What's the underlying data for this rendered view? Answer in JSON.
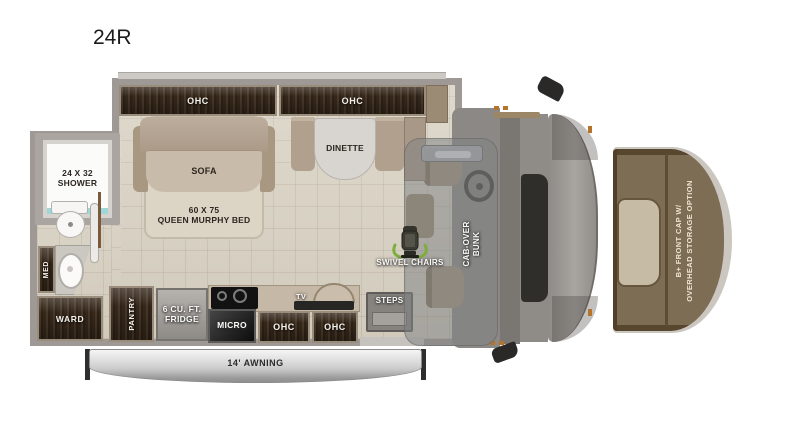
{
  "title": "24R",
  "labels": {
    "ohc": "OHC",
    "shower_l1": "24 X 32",
    "shower_l2": "SHOWER",
    "sofa": "SOFA",
    "murphy_l1": "60 X 75",
    "murphy_l2": "QUEEN MURPHY BED",
    "dinette": "DINETTE",
    "med": "MED",
    "ward": "WARD",
    "pantry": "PANTRY",
    "fridge_l1": "6 CU. FT.",
    "fridge_l2": "FRIDGE",
    "micro": "MICRO",
    "tv": "TV",
    "steps": "STEPS",
    "swivel_chairs": "SWIVEL CHAIRS",
    "bunk_l1": "CAB-OVER",
    "bunk_l2": "BUNK",
    "awning": "14' AWNING",
    "front_cap_l1": "B+ FRONT CAP W/",
    "front_cap_l2": "OVERHEAD STORAGE OPTION"
  },
  "colors": {
    "floor_tile": "#d8d1c2",
    "wall_gray": "#9e9995",
    "wood_dark": "#34271b",
    "wood_frame": "#9a8d7b",
    "upholstery_tan": "#b3a492",
    "awning_silver": "#c9c9c9",
    "front_cap_brown": "#7e6d55",
    "swivel_arrow_green": "#7fae3f",
    "shower_accent_teal": "#9fd6d8"
  }
}
